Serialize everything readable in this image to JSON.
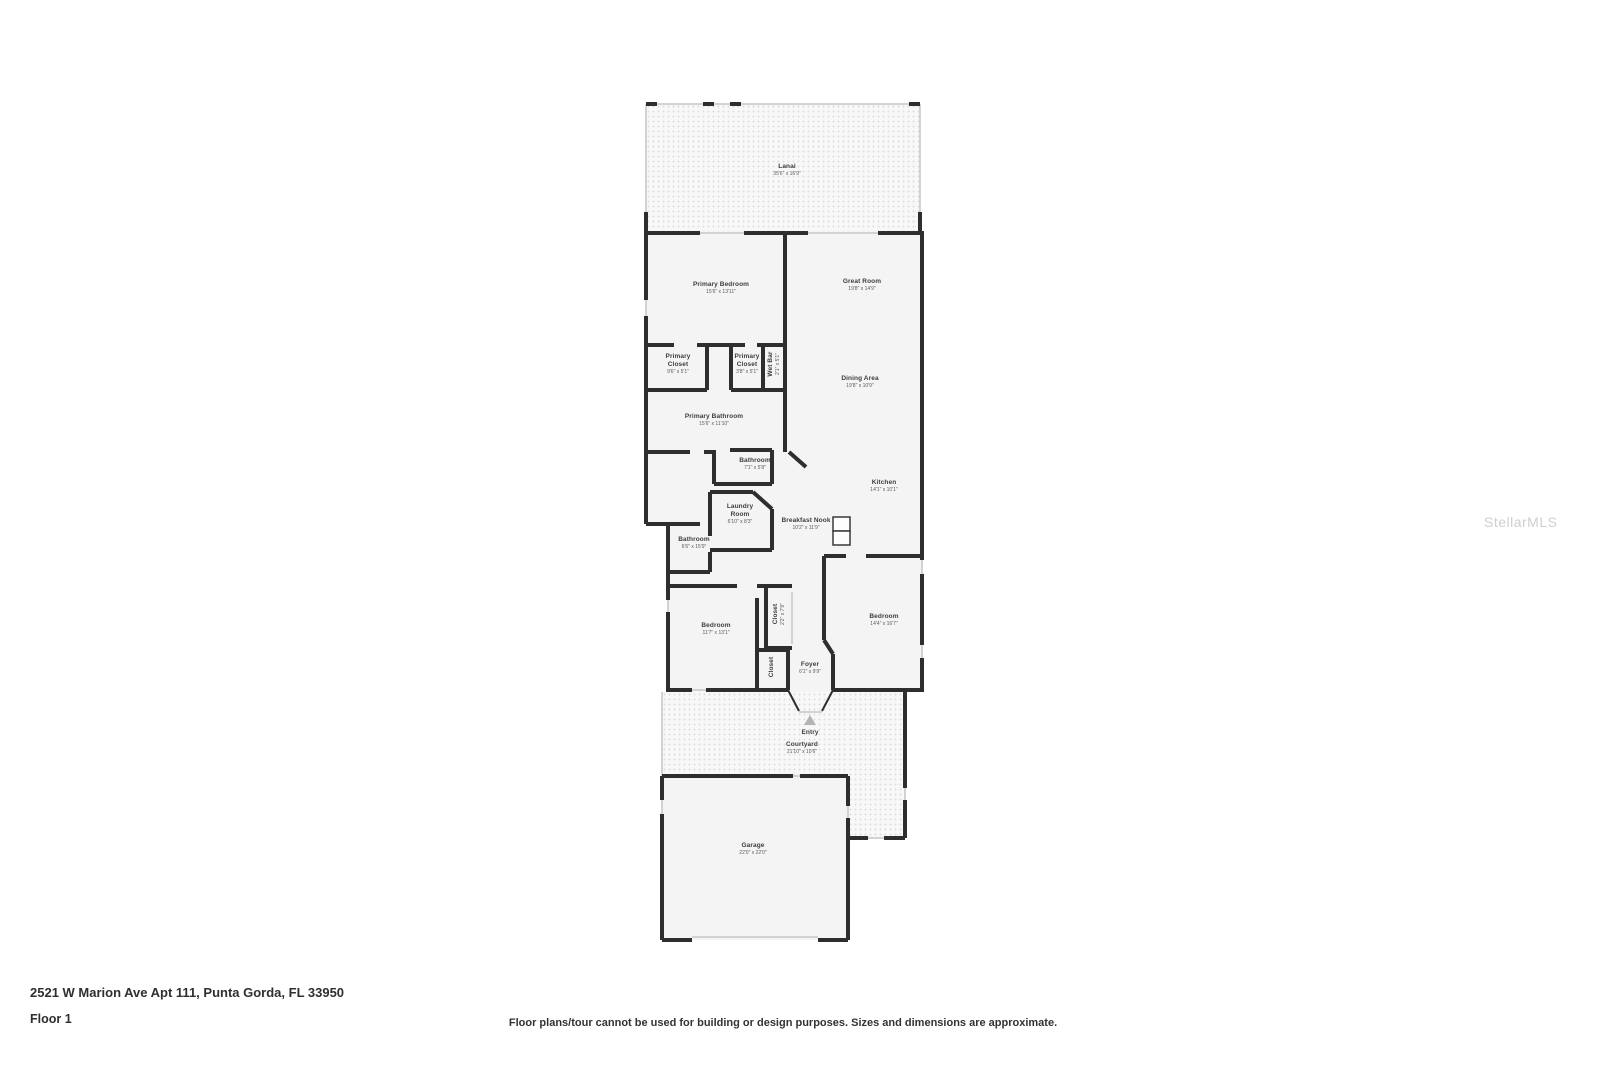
{
  "watermark": "StellarMLS",
  "footer": {
    "address": "2521 W Marion Ave Apt 111, Punta Gorda, FL 33950",
    "floor": "Floor 1",
    "disclaimer": "Floor plans/tour cannot be used for building or design purposes. Sizes and dimensions are approximate."
  },
  "rooms": [
    {
      "name": "Lanai",
      "dims": "35'6\" x 16'9\""
    },
    {
      "name": "Primary Bedroom",
      "dims": "15'6\" x 13'11\""
    },
    {
      "name": "Great Room",
      "dims": "19'8\" x 14'9\""
    },
    {
      "name": "Primary Closet",
      "dims": "9'6\" x 5'1\""
    },
    {
      "name": "Primary Closet",
      "dims": "3'8\" x 5'1\""
    },
    {
      "name": "Wet Bar",
      "dims": "2'1\" x 5'1\""
    },
    {
      "name": "Dining Area",
      "dims": "19'8\" x 10'9\""
    },
    {
      "name": "Primary Bathroom",
      "dims": "15'6\" x 11'10\""
    },
    {
      "name": "Bathroom",
      "dims": "7'1\" x 5'8\""
    },
    {
      "name": "Laundry Room",
      "dims": "6'10\" x 8'3\""
    },
    {
      "name": "Breakfast Nook",
      "dims": "10'2\" x 11'9\""
    },
    {
      "name": "Kitchen",
      "dims": "14'1\" x 10'1\""
    },
    {
      "name": "Bathroom",
      "dims": "6'6\" x 15'9\""
    },
    {
      "name": "Bedroom",
      "dims": "11'7\" x 13'1\""
    },
    {
      "name": "Closet",
      "dims": "2'2\" x 7'9\""
    },
    {
      "name": "Closet",
      "dims": ""
    },
    {
      "name": "Bedroom",
      "dims": "14'4\" x 16'7\""
    },
    {
      "name": "Foyer",
      "dims": "6'1\" x 9'9\""
    },
    {
      "name": "Entry",
      "dims": ""
    },
    {
      "name": "Courtyard",
      "dims": "21'10\" x 10'6\""
    },
    {
      "name": "Garage",
      "dims": "22'0\" x 22'0\""
    }
  ]
}
